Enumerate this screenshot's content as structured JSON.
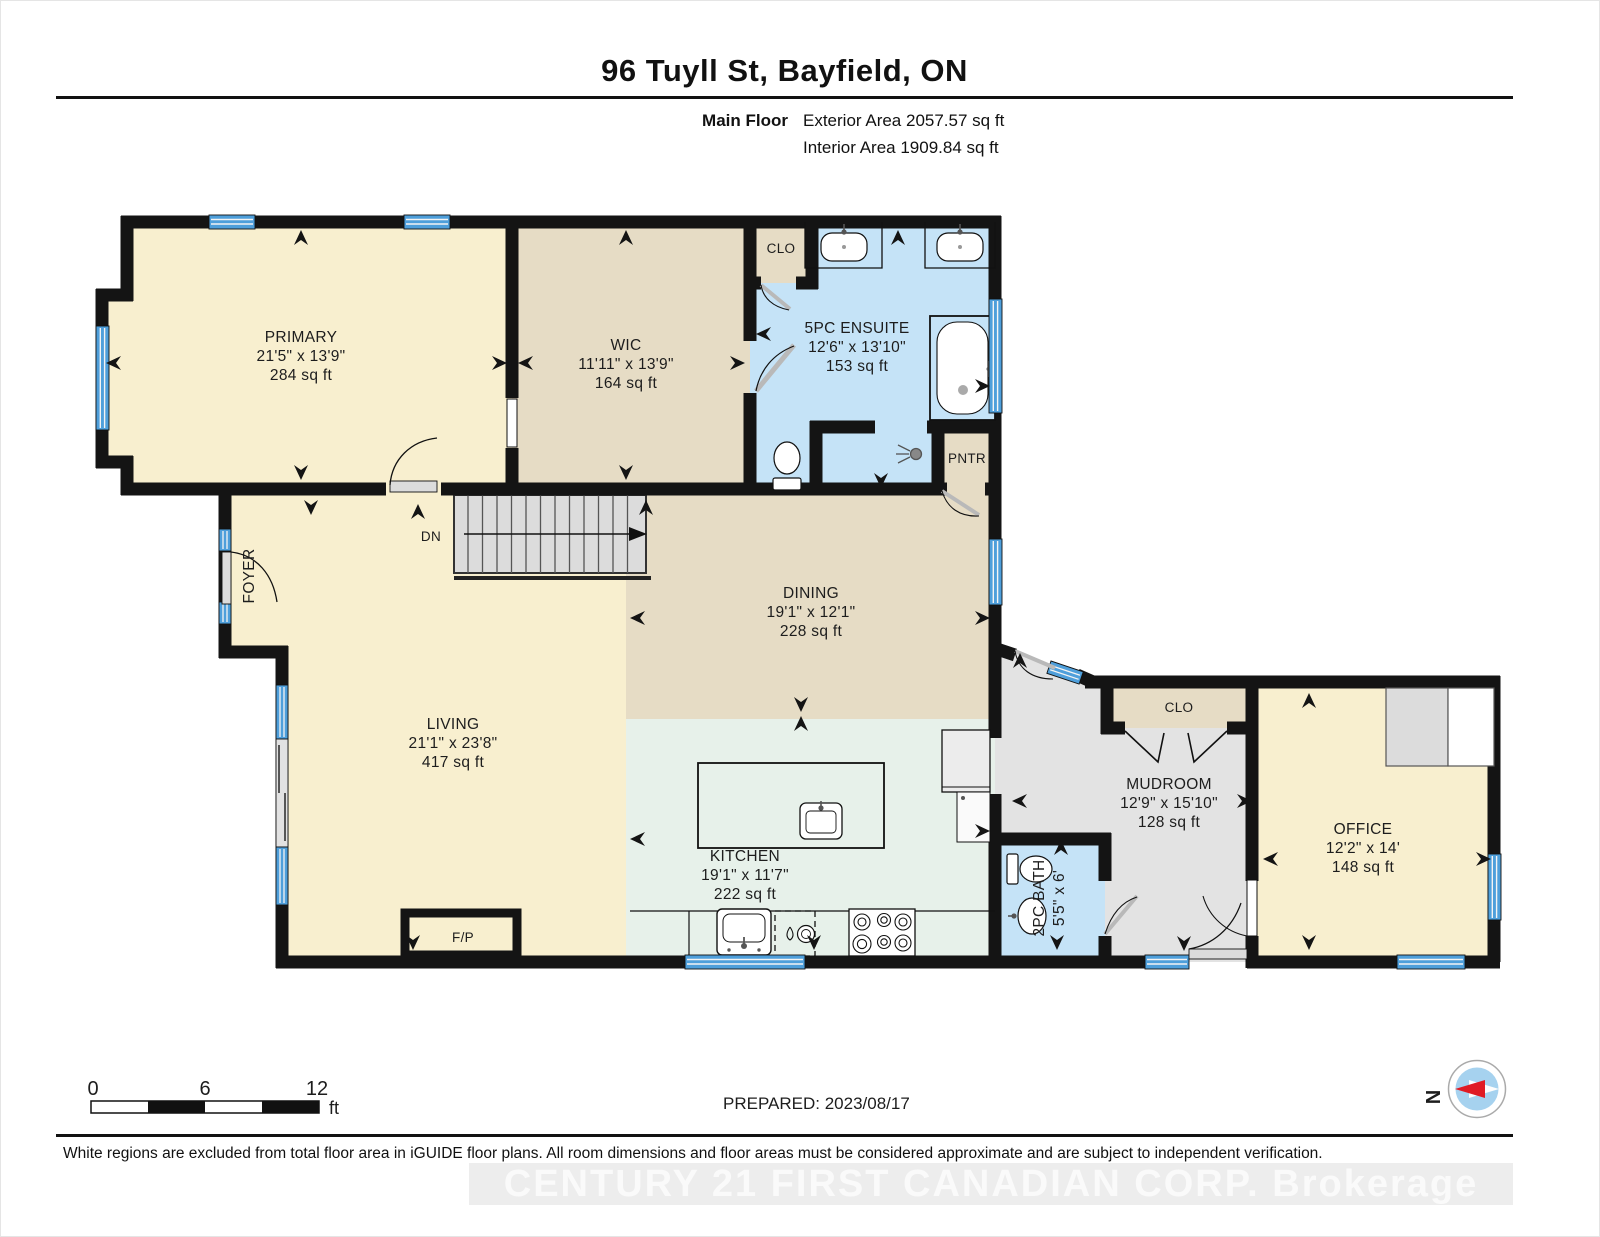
{
  "header": {
    "title": "96 Tuyll St, Bayfield, ON",
    "floor_label": "Main Floor",
    "exterior_area": "Exterior Area 2057.57 sq ft",
    "interior_area": "Interior Area 1909.84 sq ft"
  },
  "rooms": {
    "primary": {
      "name": "PRIMARY",
      "dims": "21'5\" x 13'9\"",
      "area": "284 sq ft"
    },
    "wic": {
      "name": "WIC",
      "dims": "11'11\" x 13'9\"",
      "area": "164 sq ft"
    },
    "ensuite": {
      "name": "5PC ENSUITE",
      "dims": "12'6\" x 13'10\"",
      "area": "153 sq ft"
    },
    "closet_top": {
      "name": "CLO"
    },
    "pantry": {
      "name": "PNTR"
    },
    "dining": {
      "name": "DINING",
      "dims": "19'1\" x 12'1\"",
      "area": "228 sq ft"
    },
    "living": {
      "name": "LIVING",
      "dims": "21'1\" x 23'8\"",
      "area": "417 sq ft"
    },
    "foyer": {
      "name": "FOYER"
    },
    "kitchen": {
      "name": "KITCHEN",
      "dims": "19'1\" x 11'7\"",
      "area": "222 sq ft"
    },
    "mudroom": {
      "name": "MUDROOM",
      "dims": "12'9\" x 15'10\"",
      "area": "128 sq ft"
    },
    "closet_mud": {
      "name": "CLO"
    },
    "bath": {
      "name": "2PC BATH",
      "dims": "5'5\" x 6'"
    },
    "office": {
      "name": "OFFICE",
      "dims": "12'2\" x 14'",
      "area": "148 sq ft"
    },
    "fireplace": {
      "name": "F/P"
    },
    "stairs": {
      "name": "DN"
    }
  },
  "scale_bar": {
    "t0": "0",
    "t6": "6",
    "t12": "12",
    "unit": "ft"
  },
  "prepared": "PREPARED: 2023/08/17",
  "compass": {
    "north": "N"
  },
  "footer": {
    "disclaimer": "White regions are excluded from total floor area in iGUIDE floor plans. All room dimensions and floor areas must be considered approximate and are subject to independent verification.",
    "watermark": "CENTURY 21 FIRST CANADIAN CORP. Brokerage"
  },
  "colors": {
    "room_cream": "#F8EFCF",
    "room_tan": "#E6DCC5",
    "room_blue": "#C5E3F7",
    "room_mint": "#E7F1EA",
    "room_gray": "#E3E3E3",
    "window_blue": "#4E9FDB",
    "wall_black": "#141414",
    "compass_red": "#E01B24",
    "compass_blue": "#A6D2EF"
  }
}
